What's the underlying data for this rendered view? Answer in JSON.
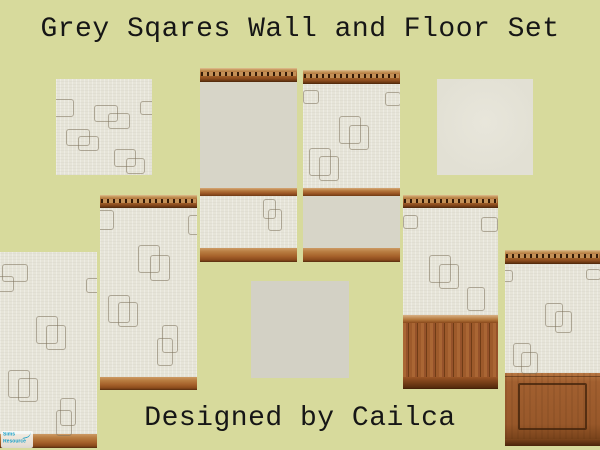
{
  "page": {
    "title": "Grey Sqares Wall and Floor Set",
    "credit": "Designed by Cailca"
  },
  "watermark": {
    "line1": "Sims",
    "line2": "Resource"
  },
  "colors": {
    "background": "#d7da9c",
    "text": "#161616",
    "wallpaper": "#e6e4d8",
    "plain_wall": "#d7d5c8",
    "floor_cream": "#e2e0d4",
    "floor_grey": "#d3d1c5",
    "wood_light": "#c89a5e",
    "wood_mid": "#a4632c",
    "wood_dark": "#5f3210",
    "watermark_teal": "#18a0c8"
  },
  "swatches": [
    {
      "id": "floor-textured-squares",
      "label": "floor tile with squares texture",
      "x": 56,
      "y": 79,
      "w": 96,
      "h": 96,
      "parts": [
        {
          "k": "paper",
          "h": 96
        }
      ],
      "motifs": [
        [
          -8,
          20,
          24,
          16
        ],
        [
          84,
          22,
          18,
          12
        ],
        [
          38,
          26,
          22,
          15
        ],
        [
          52,
          34,
          20,
          14
        ],
        [
          10,
          50,
          22,
          15
        ],
        [
          22,
          57,
          19,
          13
        ],
        [
          58,
          70,
          20,
          16
        ],
        [
          70,
          79,
          17,
          14
        ]
      ]
    },
    {
      "id": "wall-plain-top-squares-bottom",
      "label": "wall with plain upper and squares lower",
      "x": 200,
      "y": 68,
      "w": 97,
      "h": 194,
      "parts": [
        {
          "k": "crown",
          "h": 14
        },
        {
          "k": "plain",
          "h": 106
        },
        {
          "k": "rail",
          "h": 8
        },
        {
          "k": "paper",
          "h": 52
        },
        {
          "k": "base",
          "h": 14
        }
      ],
      "motifs": [
        [
          63,
          131,
          11,
          18
        ],
        [
          68,
          141,
          12,
          20
        ]
      ]
    },
    {
      "id": "wall-squares-top-plain-bottom",
      "label": "wall with squares upper and plain lower",
      "x": 303,
      "y": 70,
      "w": 97,
      "h": 192,
      "parts": [
        {
          "k": "crown",
          "h": 14
        },
        {
          "k": "paper",
          "h": 104
        },
        {
          "k": "rail",
          "h": 8
        },
        {
          "k": "plain",
          "h": 52
        },
        {
          "k": "base",
          "h": 14
        }
      ],
      "motifs": [
        [
          0,
          20,
          14,
          12
        ],
        [
          82,
          22,
          14,
          12
        ],
        [
          36,
          46,
          20,
          26
        ],
        [
          46,
          55,
          18,
          23
        ],
        [
          6,
          78,
          20,
          26
        ],
        [
          16,
          86,
          18,
          23
        ]
      ]
    },
    {
      "id": "floor-plain-cream",
      "label": "plain cream floor tile",
      "x": 437,
      "y": 79,
      "w": 96,
      "h": 96,
      "parts": [
        {
          "k": "floorCream",
          "h": 96
        }
      ],
      "motifs": []
    },
    {
      "id": "wall-crown-and-baseboard",
      "label": "squares wall with crown molding and baseboard",
      "x": 100,
      "y": 195,
      "w": 97,
      "h": 195,
      "parts": [
        {
          "k": "crown",
          "h": 13
        },
        {
          "k": "paper",
          "h": 169
        },
        {
          "k": "base",
          "h": 13
        }
      ],
      "motifs": [
        [
          -4,
          15,
          16,
          18
        ],
        [
          88,
          20,
          12,
          18
        ],
        [
          38,
          50,
          20,
          26
        ],
        [
          50,
          60,
          18,
          24
        ],
        [
          8,
          100,
          20,
          26
        ],
        [
          18,
          107,
          18,
          23
        ],
        [
          62,
          130,
          14,
          26
        ],
        [
          57,
          143,
          14,
          26
        ]
      ]
    },
    {
      "id": "wall-beadboard-wainscot",
      "label": "squares wall with beadboard wainscot",
      "x": 403,
      "y": 195,
      "w": 95,
      "h": 194,
      "parts": [
        {
          "k": "crown",
          "h": 13
        },
        {
          "k": "paper",
          "h": 107
        },
        {
          "k": "bead",
          "h": 74
        }
      ],
      "motifs": [
        [
          0,
          20,
          13,
          12
        ],
        [
          78,
          22,
          15,
          13
        ],
        [
          26,
          60,
          20,
          26
        ],
        [
          36,
          69,
          18,
          23
        ],
        [
          64,
          92,
          16,
          22
        ]
      ]
    },
    {
      "id": "wall-panel-wainscot",
      "label": "squares wall with raised panel wainscot",
      "x": 505,
      "y": 250,
      "w": 95,
      "h": 196,
      "parts": [
        {
          "k": "crown",
          "h": 14
        },
        {
          "k": "paper",
          "h": 109
        },
        {
          "k": "panel",
          "h": 73
        }
      ],
      "motifs": [
        [
          -4,
          20,
          10,
          10
        ],
        [
          81,
          19,
          13,
          9
        ],
        [
          40,
          53,
          16,
          22
        ],
        [
          50,
          61,
          15,
          20
        ],
        [
          8,
          93,
          16,
          22
        ],
        [
          16,
          102,
          15,
          20
        ]
      ]
    },
    {
      "id": "floor-plain-grey",
      "label": "plain grey floor tile",
      "x": 251,
      "y": 281,
      "w": 98,
      "h": 97,
      "parts": [
        {
          "k": "floorGrey",
          "h": 97
        }
      ],
      "motifs": []
    },
    {
      "id": "wall-wallpaper-baseboard",
      "label": "squares wall with baseboard only",
      "x": 0,
      "y": 252,
      "w": 97,
      "h": 196,
      "parts": [
        {
          "k": "paper",
          "h": 182
        },
        {
          "k": "base",
          "h": 14
        }
      ],
      "motifs": [
        [
          2,
          12,
          24,
          16
        ],
        [
          -6,
          24,
          18,
          14
        ],
        [
          86,
          26,
          12,
          13
        ],
        [
          36,
          64,
          20,
          26
        ],
        [
          46,
          73,
          18,
          23
        ],
        [
          8,
          118,
          20,
          26
        ],
        [
          18,
          126,
          18,
          22
        ],
        [
          60,
          146,
          14,
          26
        ],
        [
          56,
          158,
          14,
          24
        ]
      ]
    }
  ]
}
